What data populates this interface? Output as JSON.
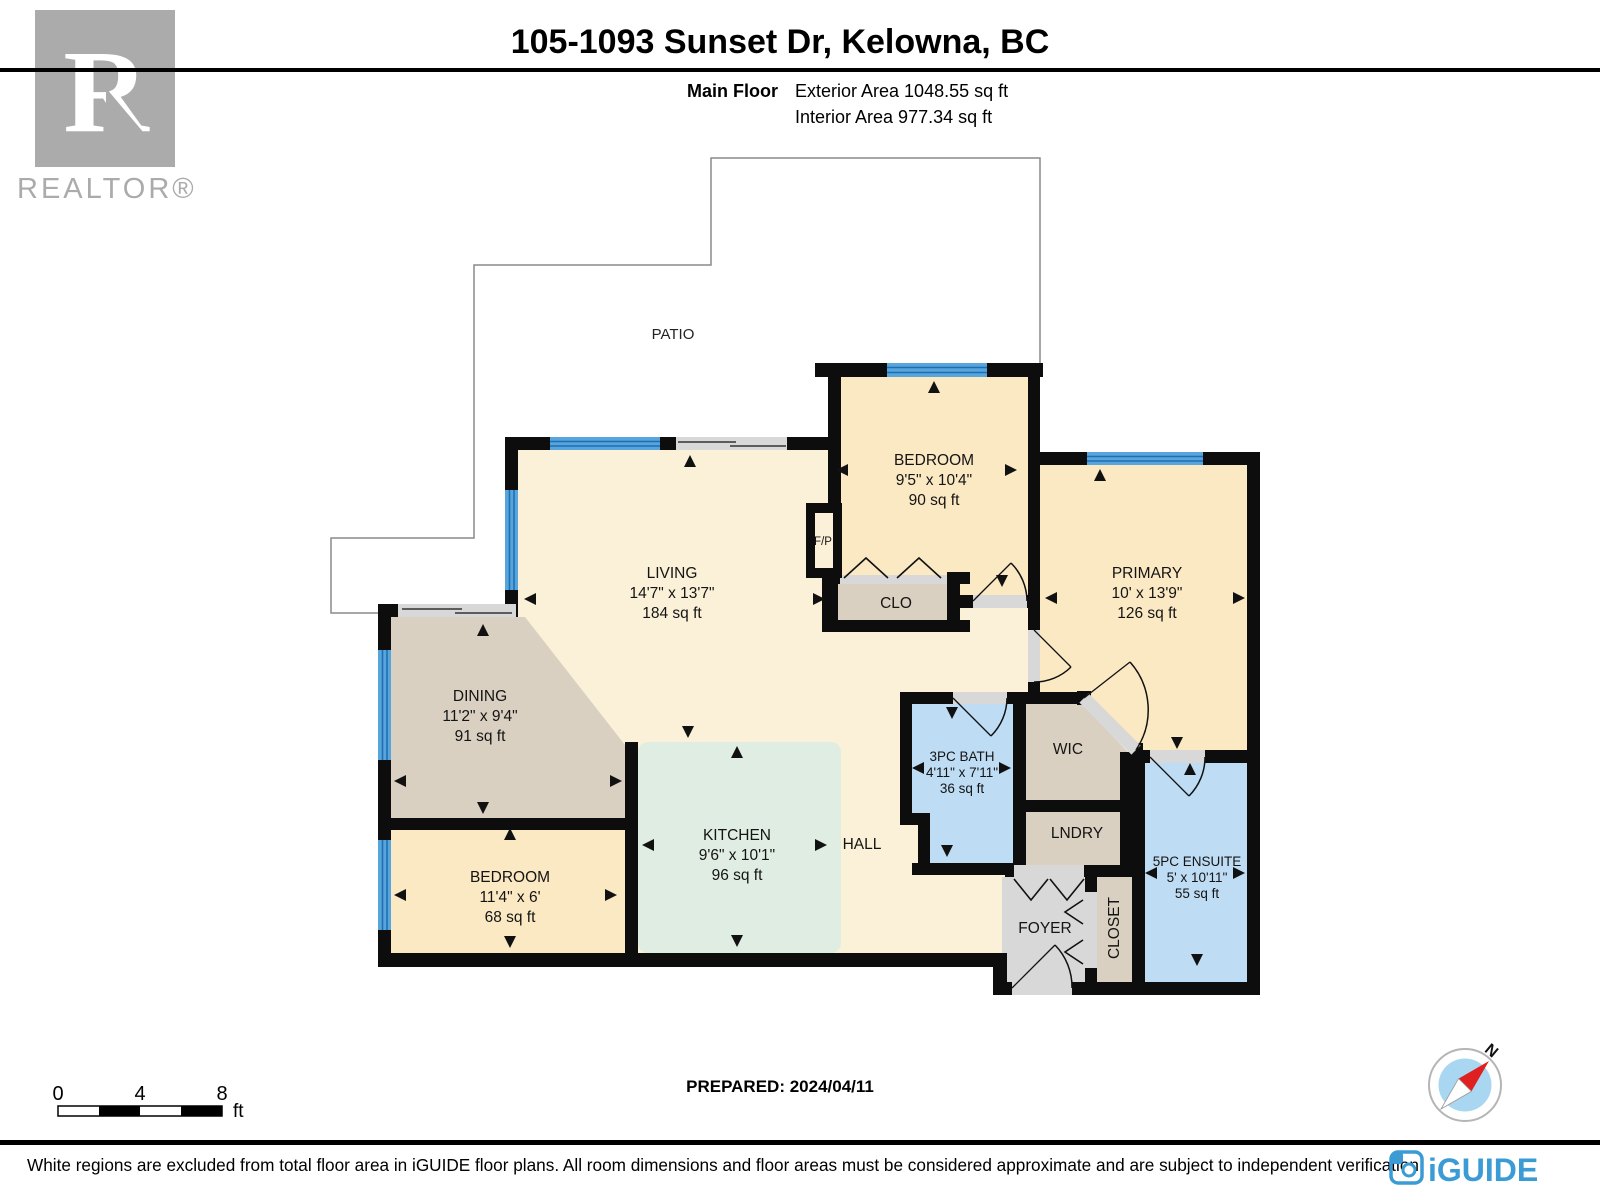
{
  "header": {
    "title": "105-1093 Sunset Dr, Kelowna, BC",
    "floor_label": "Main Floor",
    "exterior_area_label": "Exterior Area 1048.55 sq ft",
    "interior_area_label": "Interior Area 977.34 sq ft"
  },
  "branding": {
    "realtor_letter": "R",
    "realtor_wordmark": "REALTOR®",
    "iguide_wordmark": "iGUIDE",
    "iguide_blue": "#3a9bd5",
    "realtor_gray": "#ababab"
  },
  "plan": {
    "patio_label": "PATIO",
    "hall_label": "HALL",
    "fp_label": "F/P",
    "clo_label": "CLO",
    "wic_label": "WIC",
    "lndry_label": "LNDRY",
    "foyer_label": "FOYER",
    "closet_label": "CLOSET",
    "rooms": {
      "living": {
        "name": "LIVING",
        "dims": "14'7\" x 13'7\"",
        "area": "184 sq ft"
      },
      "dining": {
        "name": "DINING",
        "dims": "11'2\" x 9'4\"",
        "area": "91 sq ft"
      },
      "kitchen": {
        "name": "KITCHEN",
        "dims": "9'6\" x 10'1\"",
        "area": "96 sq ft"
      },
      "bedroom2": {
        "name": "BEDROOM",
        "dims": "11'4\" x 6'",
        "area": "68 sq ft"
      },
      "bedroom1": {
        "name": "BEDROOM",
        "dims": "9'5\" x 10'4\"",
        "area": "90 sq ft"
      },
      "primary": {
        "name": "PRIMARY",
        "dims": "10' x 13'9\"",
        "area": "126 sq ft"
      },
      "bath": {
        "name": "3PC BATH",
        "dims": "4'11\" x 7'11\"",
        "area": "36 sq ft"
      },
      "ensuite": {
        "name": "5PC ENSUITE",
        "dims": "5' x 10'11\"",
        "area": "55 sq ft"
      }
    },
    "colors": {
      "wall": "#0d0d0d",
      "living_floor": "#faf1d8",
      "bedroom_floor": "#fbe9c4",
      "closet_floor": "#d9d0c1",
      "kitchen_floor": "#e0ede3",
      "bath_floor": "#beddf5",
      "foyer_floor": "#d8d8d8",
      "window": "#57a5dc"
    }
  },
  "scalebar": {
    "t0": "0",
    "t4": "4",
    "t8": "8",
    "unit": "ft"
  },
  "compass": {
    "north": "N"
  },
  "prepared_label": "PREPARED: 2024/04/11",
  "footer_disclaimer": "White regions are excluded from total floor area in iGUIDE floor plans. All room dimensions and floor areas must be considered approximate and are subject to independent verification."
}
